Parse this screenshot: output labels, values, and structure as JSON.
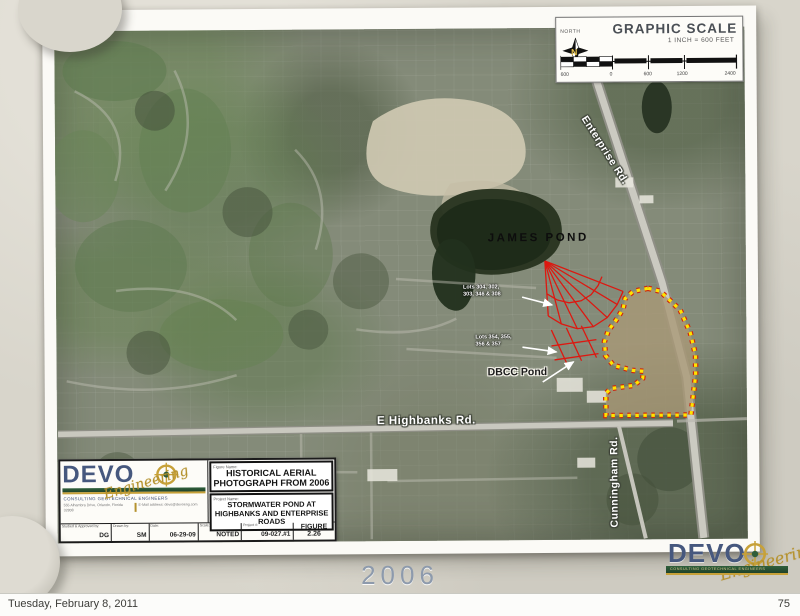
{
  "slide": {
    "year_label": "2006",
    "footer": {
      "date_text": "Tuesday, February 8, 2011",
      "page_number": "75"
    }
  },
  "map": {
    "labels": {
      "james_pond": "JAMES POND",
      "dbcc_pond": "DBCC Pond",
      "highbanks_rd": "E Highbanks Rd.",
      "enterprise_rd": "Enterprise Rd.",
      "cunningham_rd": "Cunningham Rd.",
      "lots_upper_line1": "Lots 304, 302,",
      "lots_upper_line2": "303, 346 & 308",
      "lots_lower_line1": "Lots 354, 355,",
      "lots_lower_line2": "356 & 357"
    },
    "scale_box": {
      "north_label": "NORTH",
      "compass_letter": "N",
      "title": "GRAPHIC SCALE",
      "subtitle": "1 INCH = 600 FEET",
      "ticks": [
        "600",
        "0",
        "600",
        "1200",
        "2400"
      ]
    },
    "colors": {
      "annotation_red": "#dd1810",
      "boundary_yellow": "#ffe300",
      "label_white": "#ffffff",
      "label_black": "#111111"
    }
  },
  "title_block": {
    "figure_name_label": "Figure Name:",
    "figure_name": "HISTORICAL AERIAL PHOTOGRAPH FROM 2006",
    "project_name_label": "Project Name:",
    "project_name": "STORMWATER POND AT HIGHBANKS AND ENTERPRISE ROADS",
    "fields": [
      {
        "label": "Studied & Approved by:",
        "value": "DG"
      },
      {
        "label": "Drawn by:",
        "value": "SM"
      },
      {
        "label": "Date:",
        "value": "06-29-09"
      },
      {
        "label": "Scale:",
        "value": "NOTED"
      },
      {
        "label": "Project #:",
        "value": "09-027.#1"
      },
      {
        "label": "",
        "value": "FIGURE 2.26"
      }
    ],
    "logo": {
      "name": "DEVO",
      "script": "Engineering",
      "tagline": "CONSULTING GEOTECHNICAL ENGINEERS",
      "address_left": "555 Alhambra Drive, Orlando, Florida 32808",
      "address_right": "E-Mail address: devo@devoeng.com"
    }
  },
  "footer_logo": {
    "name": "DEVO",
    "script": "Engineering",
    "tagline": "CONSULTING GEOTECHNICAL ENGINEERS"
  }
}
